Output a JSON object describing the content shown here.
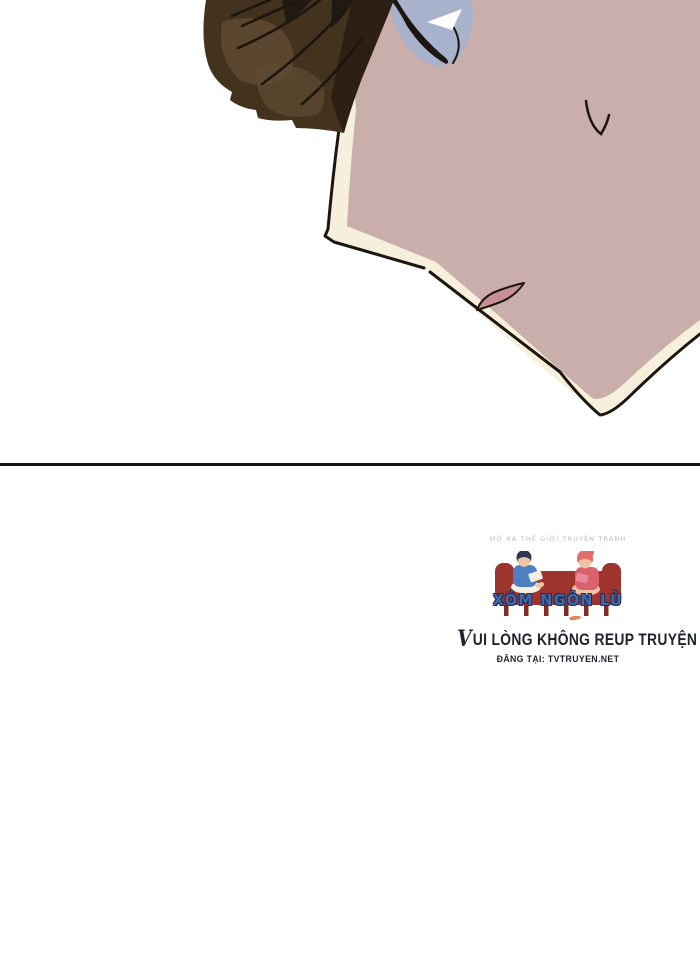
{
  "palette": {
    "page_bg": "#ffffff",
    "skin_pink": "#c9aeac",
    "skin_cream": "#f6efdb",
    "mouth_pink": "#c78f94",
    "hair_base": "#43321e",
    "hair_dark": "#2b2013",
    "hair_light": "#5f4b33",
    "eye_blue": "#a8b2cc",
    "line_black": "#1c1510",
    "divider": "#161616",
    "navy_text": "#1c232e",
    "tagline_gray": "#b8bcc4",
    "logo_blue": "#3e6ab2",
    "logo_outline": "#222f4e",
    "sofa_red": "#9e342e",
    "sofa_red_dark": "#852b26",
    "boy_shirt": "#4e7fc0",
    "boy_hair": "#2c3850",
    "girl_hair": "#e0706c",
    "girl_dress": "#d8636e",
    "logo_skin": "#f2c2a4",
    "book_cream": "#f5efe2",
    "squiggle_orange": "#d98a5f"
  },
  "artwork": {
    "panel_icon": "bowed-head-character-illustration"
  },
  "watermark": {
    "logo_icon": "couple-reading-on-sofa-icon",
    "tagline": "MỞ RA THẾ GIỚI TRUYỆN TRANH",
    "logo_text": "XÓM NGÔN LÙ",
    "notice_initial": "V",
    "notice_rest": "UI LÒNG KHÔNG REUP TRUYỆN",
    "source_label": "ĐĂNG TẠI: TVTRUYEN.NET"
  }
}
